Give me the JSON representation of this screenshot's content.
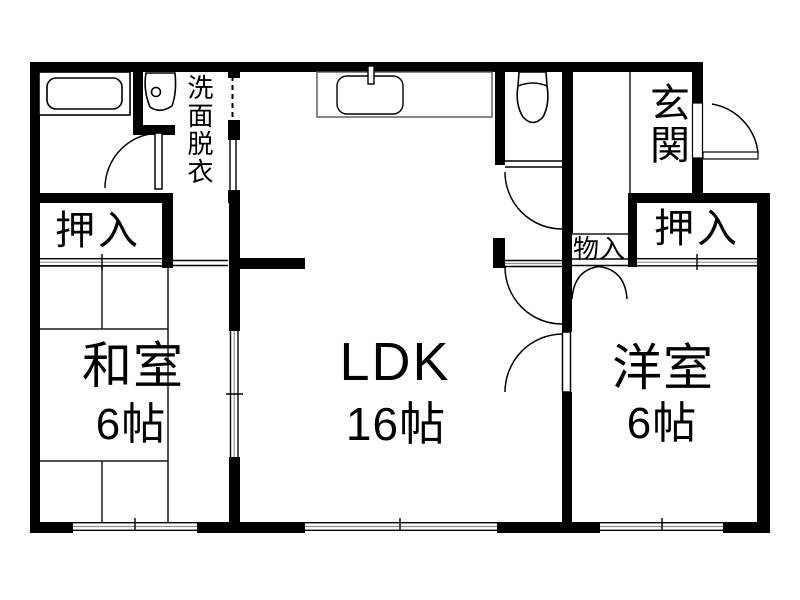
{
  "floorplan": {
    "type": "japanese-apartment-floorplan",
    "rooms": {
      "ldk": {
        "name": "LDK",
        "size": "16帖"
      },
      "washitsu": {
        "name": "和室",
        "size": "6帖"
      },
      "youshitsu": {
        "name": "洋室",
        "size": "6帖"
      },
      "genkan": {
        "name": "玄関"
      },
      "senmen": {
        "name": "洗面脱衣"
      },
      "oshiire_left": {
        "name": "押入"
      },
      "oshiire_right": {
        "name": "押入"
      },
      "monoire": {
        "name": "物入"
      }
    },
    "icons": [
      "bathtub",
      "washbasin",
      "kitchen-counter-sink",
      "toilet"
    ],
    "colors": {
      "wall": "#000000",
      "line": "#1a1a1a",
      "mid_line": "#909090",
      "background": "#ffffff"
    }
  }
}
